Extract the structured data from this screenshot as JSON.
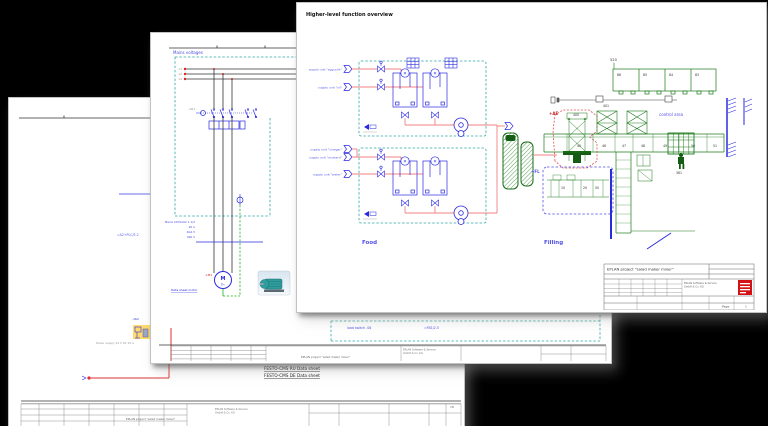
{
  "colors": {
    "background": "#000000",
    "page": "#ffffff",
    "structure_teal": "#2fa8a2",
    "symbol_blue": "#2a2ae0",
    "label_blue": "#5050e8",
    "pipe_red": "#f08080",
    "accent_red": "#e03030",
    "area_red": "#cc2222",
    "drawing_green": "#1c7a1c",
    "dark_green": "#145c14",
    "logo_red": "#d41216",
    "highlight_yellow": "#ffd966"
  },
  "front": {
    "title": "Higher-level function overview",
    "food": {
      "label": "Food",
      "supply_units": [
        "supply unit \"egg yolk\"",
        "supply unit \"oil\"",
        "supply unit \"vinegar\"",
        "supply unit \"mustard\"",
        "supply unit \"water\""
      ]
    },
    "filling": {
      "label": "Filling",
      "control_area": "control area",
      "area_ae": "+AE",
      "area_fl": "+FL",
      "ref_520": "520",
      "ref_400": "400",
      "ref_401": "401",
      "ref_361": "361",
      "top_stations": [
        "86",
        "85",
        "84",
        "83"
      ],
      "stations": [
        "45",
        "46",
        "47",
        "48",
        "49",
        "50",
        "51"
      ],
      "fl_stations": [
        "10",
        "20",
        "50"
      ]
    },
    "titleblock": {
      "project": "EPLAN project \"salad maker mixer\"",
      "company_line1": "EPLAN Software & Service",
      "company_line2": "GmbH & Co. KG",
      "page_label": "Page",
      "page_value": "1"
    }
  },
  "middle": {
    "header": "Mains voltages",
    "phases": [
      "L1",
      "L2",
      "L3"
    ],
    "contactor_tag": "-1Q1",
    "motor_tag": "-1M1",
    "motor_letter": "M",
    "motor_phase": "3~",
    "cable_specs": [
      "Mains CAT/LVAC 1 1/2",
      "20 A",
      "4G2.5",
      "400 V"
    ],
    "motor_link": "Data sheet motor",
    "note": "load switch -S6",
    "note_ref": "=FB1/2.5",
    "titleblock": {
      "project": "EPLAN project \"salad maker mixer\"",
      "company_line1": "EPLAN Software & Service",
      "company_line2": "GmbH & Co. KG"
    }
  },
  "back": {
    "cross_ref": "=A2+PLC/5.2",
    "cluster_tag": "-1K2",
    "supply_note": "Power supply 24 V DC 10 A",
    "links": [
      "FESTO-CMS RU Data sheet",
      "FESTO-CMS DE Data sheet"
    ],
    "page_marker": "1B",
    "titleblock": {
      "project": "EPLAN project \"salad maker mixer\"",
      "company_line1": "EPLAN Software & Service",
      "company_line2": "GmbH & Co. KG"
    }
  }
}
